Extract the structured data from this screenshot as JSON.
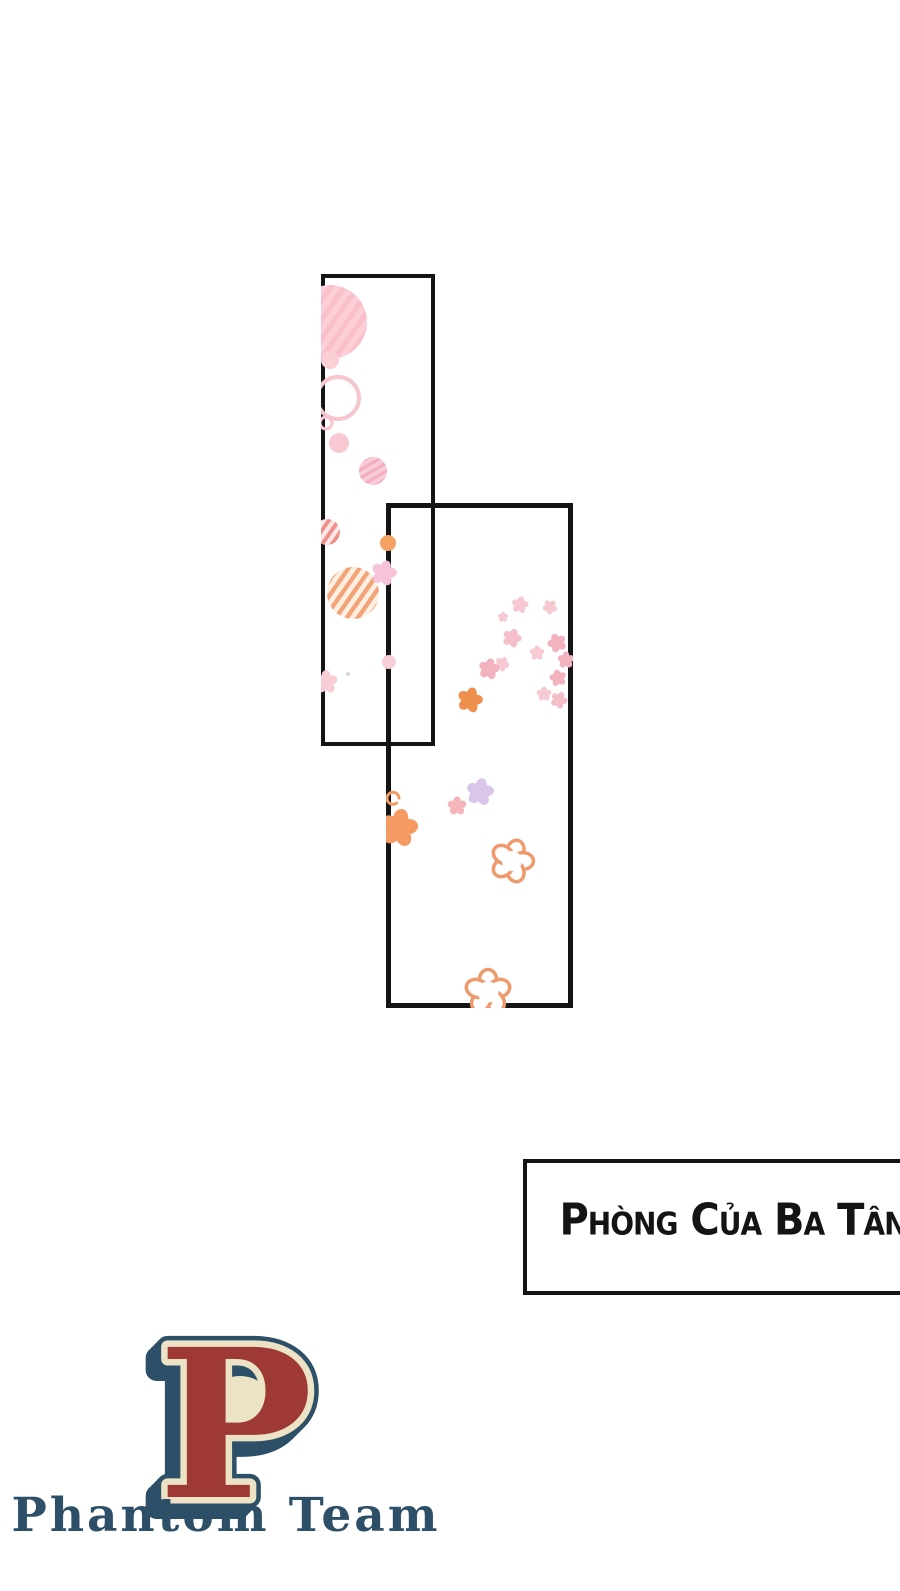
{
  "canvas": {
    "width": 900,
    "height": 1591,
    "background": "#ffffff",
    "ink": "#141414"
  },
  "panels": [
    {
      "id": "panel-1",
      "x": 321,
      "y": 274,
      "width": 114,
      "height": 472,
      "border_width": 4
    },
    {
      "id": "panel-2",
      "x": 386,
      "y": 503,
      "width": 187,
      "height": 505,
      "border_width": 5
    }
  ],
  "caption_box": {
    "text": "Phòng của ba Tân",
    "border_color": "#141414",
    "text_color": "#141414",
    "background": "#ffffff"
  },
  "logo": {
    "letter": "P",
    "team_name": "Phantom Team",
    "colors": {
      "navy": "#2d4f68",
      "red": "#9e3936",
      "cream": "#ece3c6"
    }
  },
  "decorations": [
    {
      "type": "striped-circle",
      "clip": "panel-1",
      "x": 330,
      "y": 322,
      "r": 37,
      "bg": "#fccfd7",
      "stripe": "#f9c0cb",
      "period": 11,
      "angle": 35
    },
    {
      "type": "circle",
      "clip": "panel-1",
      "x": 330,
      "y": 360,
      "r": 9,
      "color": "#fccfd7"
    },
    {
      "type": "ring",
      "clip": "panel-1",
      "x": 338,
      "y": 398,
      "r": 21,
      "color": "#f7c5ce",
      "sw": 4
    },
    {
      "type": "ring",
      "clip": "panel-1",
      "x": 326,
      "y": 423,
      "r": 6,
      "color": "#f7c5ce",
      "sw": 3
    },
    {
      "type": "circle",
      "clip": "panel-1",
      "x": 339,
      "y": 443,
      "r": 10,
      "color": "#f8c9d2"
    },
    {
      "type": "striped-circle",
      "clip": "panel-1",
      "x": 373,
      "y": 471,
      "r": 14,
      "bg": "#f9cdd8",
      "stripe": "#f3aec0",
      "period": 7,
      "angle": 60
    },
    {
      "type": "striped-circle",
      "clip": "panel-1",
      "x": 327,
      "y": 532,
      "r": 13,
      "bg": "#fce9e7",
      "stripe": "#ef8f8c",
      "period": 8,
      "angle": 35
    },
    {
      "type": "striped-circle",
      "clip": "panel-1",
      "x": 353,
      "y": 593,
      "r": 26,
      "bg": "#fdf0e3",
      "stripe": "#f2a478",
      "period": 9,
      "angle": 35
    },
    {
      "type": "flower-solid",
      "clip": "panel-1",
      "x": 384,
      "y": 573,
      "r": 12,
      "color": "#f7c3d8",
      "rot": 15
    },
    {
      "type": "circle",
      "clip": "panel-1",
      "x": 388,
      "y": 543,
      "r": 8,
      "color": "#f5a263"
    },
    {
      "type": "circle",
      "clip": "panel-1",
      "x": 389,
      "y": 662,
      "r": 7,
      "color": "#f8cfd8"
    },
    {
      "type": "flower-solid",
      "clip": "panel-1",
      "x": 326,
      "y": 682,
      "r": 11,
      "color": "#f9cdd4",
      "rot": 0
    },
    {
      "type": "dot",
      "clip": "panel-1",
      "x": 348,
      "y": 674,
      "r": 2,
      "color": "#d8d8d8"
    },
    {
      "type": "flower-solid",
      "clip": "panel-2",
      "x": 520,
      "y": 605,
      "r": 8,
      "color": "#f7c9d1",
      "rot": 10
    },
    {
      "type": "flower-solid",
      "clip": "panel-2",
      "x": 550,
      "y": 607,
      "r": 7,
      "color": "#f7c9d1",
      "rot": 40
    },
    {
      "type": "flower-solid",
      "clip": "panel-2",
      "x": 503,
      "y": 617,
      "r": 5,
      "color": "#f7c9d1",
      "rot": 0
    },
    {
      "type": "flower-solid",
      "clip": "panel-2",
      "x": 512,
      "y": 638,
      "r": 9,
      "color": "#f5bfc9",
      "rot": 20
    },
    {
      "type": "flower-solid",
      "clip": "panel-2",
      "x": 557,
      "y": 643,
      "r": 9,
      "color": "#f3b2bf",
      "rot": 50
    },
    {
      "type": "flower-solid",
      "clip": "panel-2",
      "x": 537,
      "y": 653,
      "r": 7,
      "color": "#f7c9d1",
      "rot": 0
    },
    {
      "type": "flower-solid",
      "clip": "panel-2",
      "x": 502,
      "y": 664,
      "r": 7,
      "color": "#f7c9d1",
      "rot": 30
    },
    {
      "type": "flower-solid",
      "clip": "panel-2",
      "x": 489,
      "y": 669,
      "r": 10,
      "color": "#f3b2bf",
      "rot": 12
    },
    {
      "type": "flower-solid",
      "clip": "panel-2",
      "x": 566,
      "y": 660,
      "r": 8,
      "color": "#f3b2bf",
      "rot": 0
    },
    {
      "type": "flower-solid",
      "clip": "panel-2",
      "x": 558,
      "y": 678,
      "r": 8,
      "color": "#f3b2bf",
      "rot": 60
    },
    {
      "type": "flower-solid",
      "clip": "panel-2",
      "x": 544,
      "y": 694,
      "r": 7,
      "color": "#f7c9d1",
      "rot": 0
    },
    {
      "type": "flower-solid",
      "clip": "panel-2",
      "x": 559,
      "y": 700,
      "r": 8,
      "color": "#f5bfc9",
      "rot": 25
    },
    {
      "type": "flower-solid",
      "clip": "panel-2",
      "x": 470,
      "y": 700,
      "r": 12,
      "color": "#ef8f4e",
      "rot": 15
    },
    {
      "type": "flower-solid",
      "clip": "panel-2",
      "x": 480,
      "y": 792,
      "r": 13,
      "color": "#d9c6ea",
      "rot": 10
    },
    {
      "type": "flower-solid",
      "clip": "panel-2",
      "x": 457,
      "y": 806,
      "r": 9,
      "color": "#f4b5bb",
      "rot": 0
    },
    {
      "type": "flower-solid",
      "clip": "panel-2",
      "x": 399,
      "y": 828,
      "r": 18,
      "color": "#f49a62",
      "rot": 10
    },
    {
      "type": "curl",
      "clip": "panel-2",
      "x": 393,
      "y": 798,
      "r": 6,
      "color": "#f49a62",
      "sw": 3
    },
    {
      "type": "flower-outline",
      "clip": "panel-2",
      "x": 512,
      "y": 861,
      "r": 20,
      "color": "#ef9a6d",
      "sw": 3.5,
      "rot": 18
    },
    {
      "type": "flower-outline",
      "clip": "panel-2",
      "x": 488,
      "y": 992,
      "r": 21,
      "color": "#ef9a6d",
      "sw": 3.5,
      "rot": 0
    }
  ]
}
